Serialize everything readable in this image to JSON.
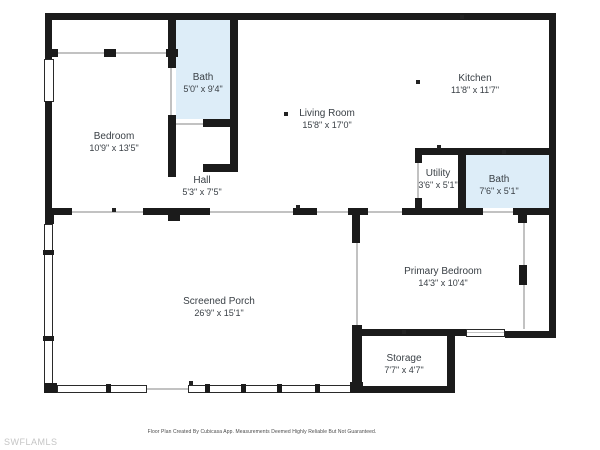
{
  "colors": {
    "wall": "#1b1b1b",
    "bath_fill": "#ddedf8",
    "label": "#3a4046",
    "thin_line": "#c2c2c2",
    "footer": "#4a4a4a",
    "watermark": "#c5c5c5"
  },
  "rooms": [
    {
      "id": "bath-top",
      "name": "Bath",
      "dims": "5'0\" x 9'4\""
    },
    {
      "id": "bedroom",
      "name": "Bedroom",
      "dims": "10'9\" x 13'5\""
    },
    {
      "id": "hall",
      "name": "Hall",
      "dims": "5'3\" x 7'5\""
    },
    {
      "id": "living-room",
      "name": "Living Room",
      "dims": "15'8\" x 17'0\""
    },
    {
      "id": "kitchen",
      "name": "Kitchen",
      "dims": "11'8\" x 11'7\""
    },
    {
      "id": "utility",
      "name": "Utility",
      "dims": "3'6\" x 5'1\""
    },
    {
      "id": "bath-right",
      "name": "Bath",
      "dims": "7'6\" x 5'1\""
    },
    {
      "id": "primary-bedroom",
      "name": "Primary Bedroom",
      "dims": "14'3\" x 10'4\""
    },
    {
      "id": "screened-porch",
      "name": "Screened Porch",
      "dims": "26'9\" x 15'1\""
    },
    {
      "id": "storage",
      "name": "Storage",
      "dims": "7'7\" x 4'7\""
    }
  ],
  "footer": {
    "disclaimer": "Floor Plan Created By Cubicasa App. Measurements Deemed Highly Reliable But Not Guaranteed."
  },
  "watermark": {
    "text": "SWFLAMLS"
  }
}
